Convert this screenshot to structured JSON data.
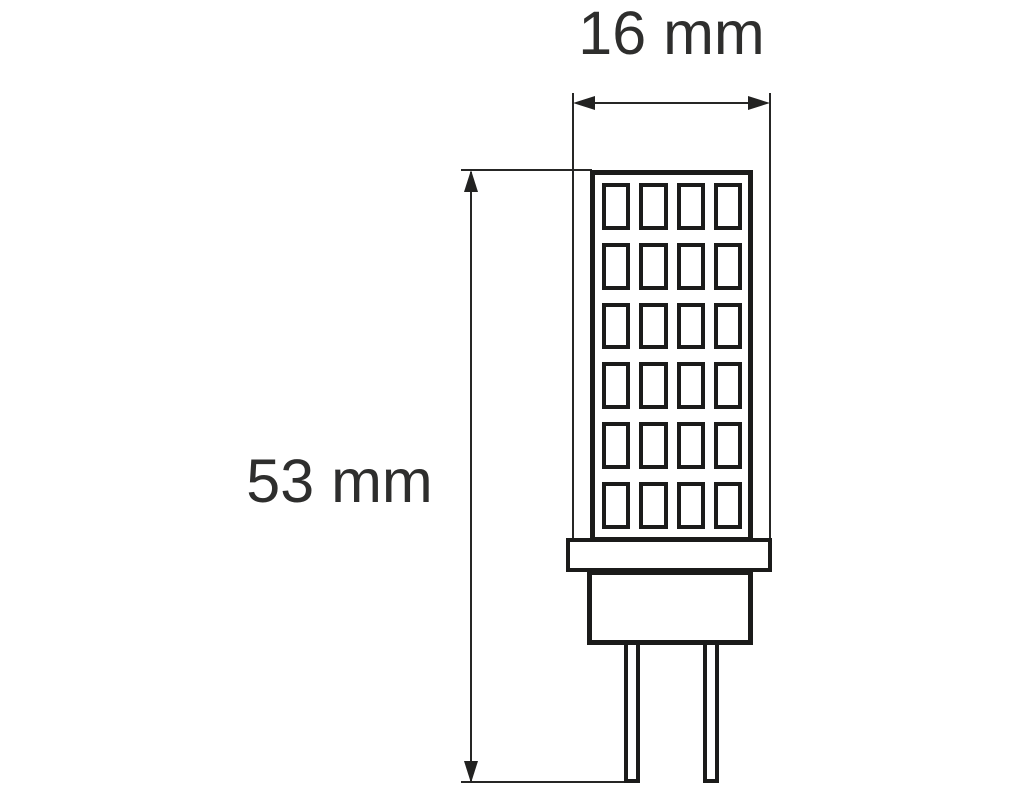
{
  "labels": {
    "width": "16 mm",
    "height": "53 mm"
  },
  "led_grid": {
    "columns": 4,
    "rows": 6
  },
  "colors": {
    "outline": "#1b1b1a",
    "dimension_line": "#262625",
    "text": "#2e2e2d",
    "background": "#ffffff"
  }
}
